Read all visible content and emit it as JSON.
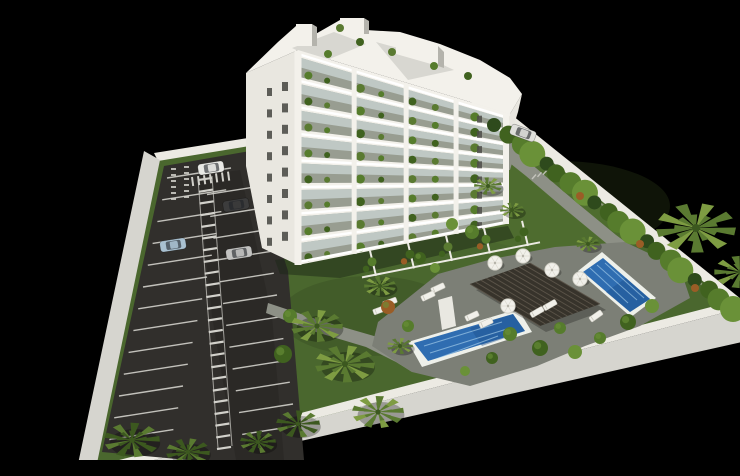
{
  "scene": {
    "title": "Aerial 3D architectural render",
    "description": "Aerial 3D render of a white 8-storey apartment building with plant-filled balconies, a walled site on a black background, asphalt parking lot with marked stalls and cars, landscaped lawns with palm trees and hedges, a grey sun deck with a dark timber pergola, white sun loungers and parasols, and two rectangular blue swimming pools.",
    "background": "#000000"
  },
  "palette": {
    "background": "#000000",
    "lawn": "#4a672e",
    "lawn_dark": "#3a5423",
    "asphalt": "#312f2c",
    "asphalt_dark": "#262523",
    "marking": "#d2d1cb",
    "wall_top": "#eceae3",
    "wall_face": "#d6d5cf",
    "wall_shade": "#b4b3ac",
    "building": "#f3f1eb",
    "building_side": "#e9e7e0",
    "facade_recess": "#989d91",
    "glass": "#c6d0cc",
    "window": "#4e4e49",
    "slab": "#ffffff",
    "roof_terrace": "#d8d7d1",
    "deck": "#7c7f76",
    "path": "#8d9086",
    "pool_rim": "#eef0ea",
    "water": "#2f6db1",
    "water_light": "#7db8dd",
    "water_deep": "#1d4f8d",
    "pergola": "#37332b",
    "pergola_slat": "#5a5348",
    "palm_light": "#7e9c42",
    "palm_mid": "#5a7a31",
    "palm_dark": "#3c581f",
    "hedge_1": "#2e4a1c",
    "hedge_2": "#40621f",
    "hedge_3": "#567c2c",
    "hedge_4": "#6a9138",
    "rust": "#9a5d26",
    "furniture": "#f1f0ea",
    "car_window": "#1e2126"
  },
  "site": {
    "areas": [
      "parking-lot",
      "apartment-building",
      "garden",
      "pool-deck"
    ],
    "building": {
      "floors_visible": 8,
      "balconies_with_plants": true,
      "facade_color": "#f3f1eb",
      "roof": "white penthouse volumes with grey terrace decks"
    },
    "parking": {
      "surface": "asphalt",
      "marking_color": "#d2d1cb",
      "stall_rows": {
        "left": 13,
        "right": 12
      },
      "walkway_stripes": 24,
      "cars": [
        {
          "id": "car-white",
          "color": "#e9e9e5"
        },
        {
          "id": "car-dark-gray",
          "color": "#3c3c3c"
        },
        {
          "id": "car-light-blue",
          "color": "#a9c1d1"
        },
        {
          "id": "car-silver",
          "color": "#c2c2c0"
        },
        {
          "id": "car-entrance-white",
          "color": "#dededa"
        }
      ]
    },
    "pools": [
      {
        "id": "pool-main-lower-left",
        "water_deep": "#2f6db1",
        "water_light": "#7db8dd"
      },
      {
        "id": "pool-upper-right",
        "water_deep": "#2f6db1",
        "water_light": "#7db8dd"
      }
    ],
    "pergola": {
      "color": "#37332b",
      "slats": 12
    },
    "furniture": {
      "sun_loungers": 9,
      "parasols": 5
    },
    "vegetation": {
      "palm_trees": 14,
      "hedge_clumps": 20,
      "bushes": 17
    }
  }
}
